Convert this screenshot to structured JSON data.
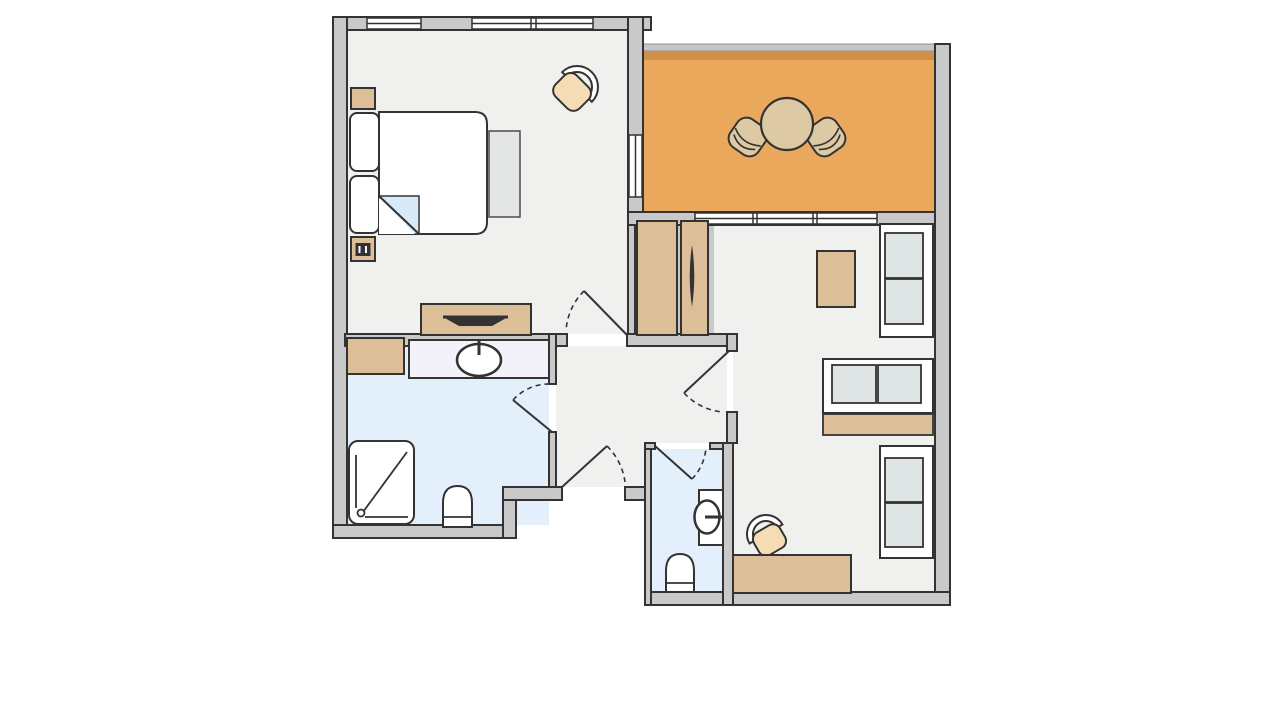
{
  "title": "apartment-floor-plan",
  "canvas": {
    "width": 1280,
    "height": 720
  },
  "colors": {
    "bg": "#ffffff",
    "wall": "#c9c9c9",
    "line": "#333333",
    "floor": "#f0f0ee",
    "wet": "#e3effa",
    "terrace": "#e9a85c",
    "terraceband": "#d28f47",
    "tan": "#dcbf98",
    "cream": "#ddc9a4",
    "peach": "#f6dcb4",
    "cushion": "#dfe5e4",
    "bench": "#e4e6e5",
    "white": "#ffffff",
    "dark": "#333333",
    "fold": "#d8e9f7",
    "vanity": "#f3f1fa",
    "railing": "#c6c6c6"
  },
  "plan": {
    "type": "floor-plan",
    "rooms": [
      {
        "name": "bedroom",
        "floor_color_key": "floor",
        "furniture": [
          "double-bed",
          "blanket-fold",
          "bedside-cushion",
          "bedside-cushion",
          "nightstand",
          "nightstand-with-phone",
          "armchair",
          "bench",
          "tv-sideboard"
        ]
      },
      {
        "name": "terrace",
        "floor_color_key": "terrace",
        "furniture": [
          "round-table",
          "terrace-chair-left",
          "terrace-chair-right"
        ]
      },
      {
        "name": "living-room",
        "floor_color_key": "floor",
        "furniture": [
          "wardrobe",
          "wardrobe-with-mirror",
          "side-table",
          "sofa-two-seat",
          "sofa-two-seat",
          "console-table",
          "sofa-two-seat",
          "desk",
          "desk-chair"
        ]
      },
      {
        "name": "bathroom",
        "floor_color_key": "wet",
        "furniture": [
          "cabinet",
          "vanity-counter",
          "washbasin",
          "shower",
          "toilet"
        ]
      },
      {
        "name": "wc",
        "floor_color_key": "wet",
        "furniture": [
          "washbasin",
          "toilet"
        ]
      },
      {
        "name": "hallway",
        "floor_color_key": "floor",
        "furniture": []
      }
    ],
    "door_count": 5,
    "window_count": 4
  }
}
